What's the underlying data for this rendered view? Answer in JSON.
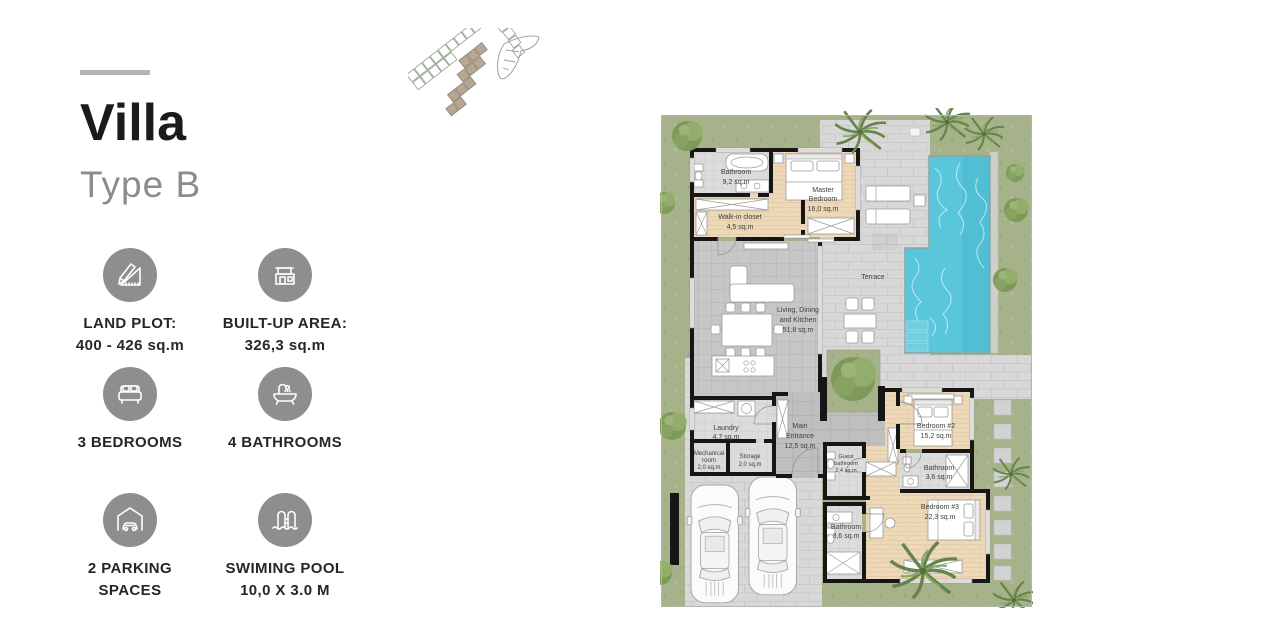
{
  "theme": {
    "accent_line": "#b3b3b3",
    "title_color": "#1b1b1b",
    "subtitle_color": "#8c8c8c",
    "label_color": "#262626",
    "icon_circle": "#8e8e8e",
    "grass": "#a6b289",
    "pavement": "#d8d8d8",
    "tile": "#c7c7c7",
    "tile_dark": "#bfbfbf",
    "bath_tile": "#dcdcdc",
    "wood": "#edd9b8",
    "wall": "#161616",
    "pool": "#5ac6da",
    "plot_highlight": "#b5a791"
  },
  "left_panel": {
    "title": "Villa",
    "subtitle": "Type B",
    "features": [
      {
        "icon": "land-plot-icon",
        "lines": [
          "LAND PLOT:",
          "400 - 426 sq.m"
        ]
      },
      {
        "icon": "built-up-area-icon",
        "lines": [
          "BUILT-UP AREA:",
          "326,3 sq.m"
        ]
      },
      {
        "icon": "bedrooms-icon",
        "lines": [
          "3 BEDROOMS"
        ]
      },
      {
        "icon": "bathrooms-icon",
        "lines": [
          "4 BATHROOMS"
        ]
      },
      {
        "icon": "parking-icon",
        "lines": [
          "2 PARKING",
          "SPACES"
        ]
      },
      {
        "icon": "swimming-pool-icon",
        "lines": [
          "SWIMING POOL",
          "10,0 X 3.0 M"
        ]
      }
    ]
  },
  "floor_plan": {
    "rooms": [
      {
        "id": "bathroom-master",
        "lines": [
          "Bathroom",
          "9,2 sq.m"
        ]
      },
      {
        "id": "master-bedroom",
        "lines": [
          "Master",
          "Bedroom",
          "16,0 sq.m"
        ]
      },
      {
        "id": "walk-in-closet",
        "lines": [
          "Walk-in closet",
          "4,5 sq.m"
        ]
      },
      {
        "id": "living-dining-kitchen",
        "lines": [
          "Living, Dining",
          "and Kitchen",
          "51,8 sq.m"
        ]
      },
      {
        "id": "terrace",
        "lines": [
          "Terrace"
        ]
      },
      {
        "id": "laundry",
        "lines": [
          "Laundry",
          "4,7 sq.m"
        ]
      },
      {
        "id": "main-entrance",
        "lines": [
          "Main",
          "Entrance",
          "12,5 sq.m"
        ]
      },
      {
        "id": "mechanical-room",
        "lines": [
          "Mechanical",
          "room",
          "2,0 sq.m"
        ]
      },
      {
        "id": "storage",
        "lines": [
          "Storage",
          "2,0 sq.m"
        ]
      },
      {
        "id": "guest-bathroom",
        "lines": [
          "Guest",
          "bathroom",
          "2,4 sq.m"
        ]
      },
      {
        "id": "bedroom-2",
        "lines": [
          "Bedroom #2",
          "15,2 sq.m"
        ]
      },
      {
        "id": "bathroom-2",
        "lines": [
          "Bathroom",
          "3,6 sq.m"
        ]
      },
      {
        "id": "bedroom-3",
        "lines": [
          "Bedroom #3",
          "22,3 sq.m"
        ]
      },
      {
        "id": "bathroom-3",
        "lines": [
          "Bathroom",
          "3,6 sq.m"
        ]
      }
    ]
  }
}
